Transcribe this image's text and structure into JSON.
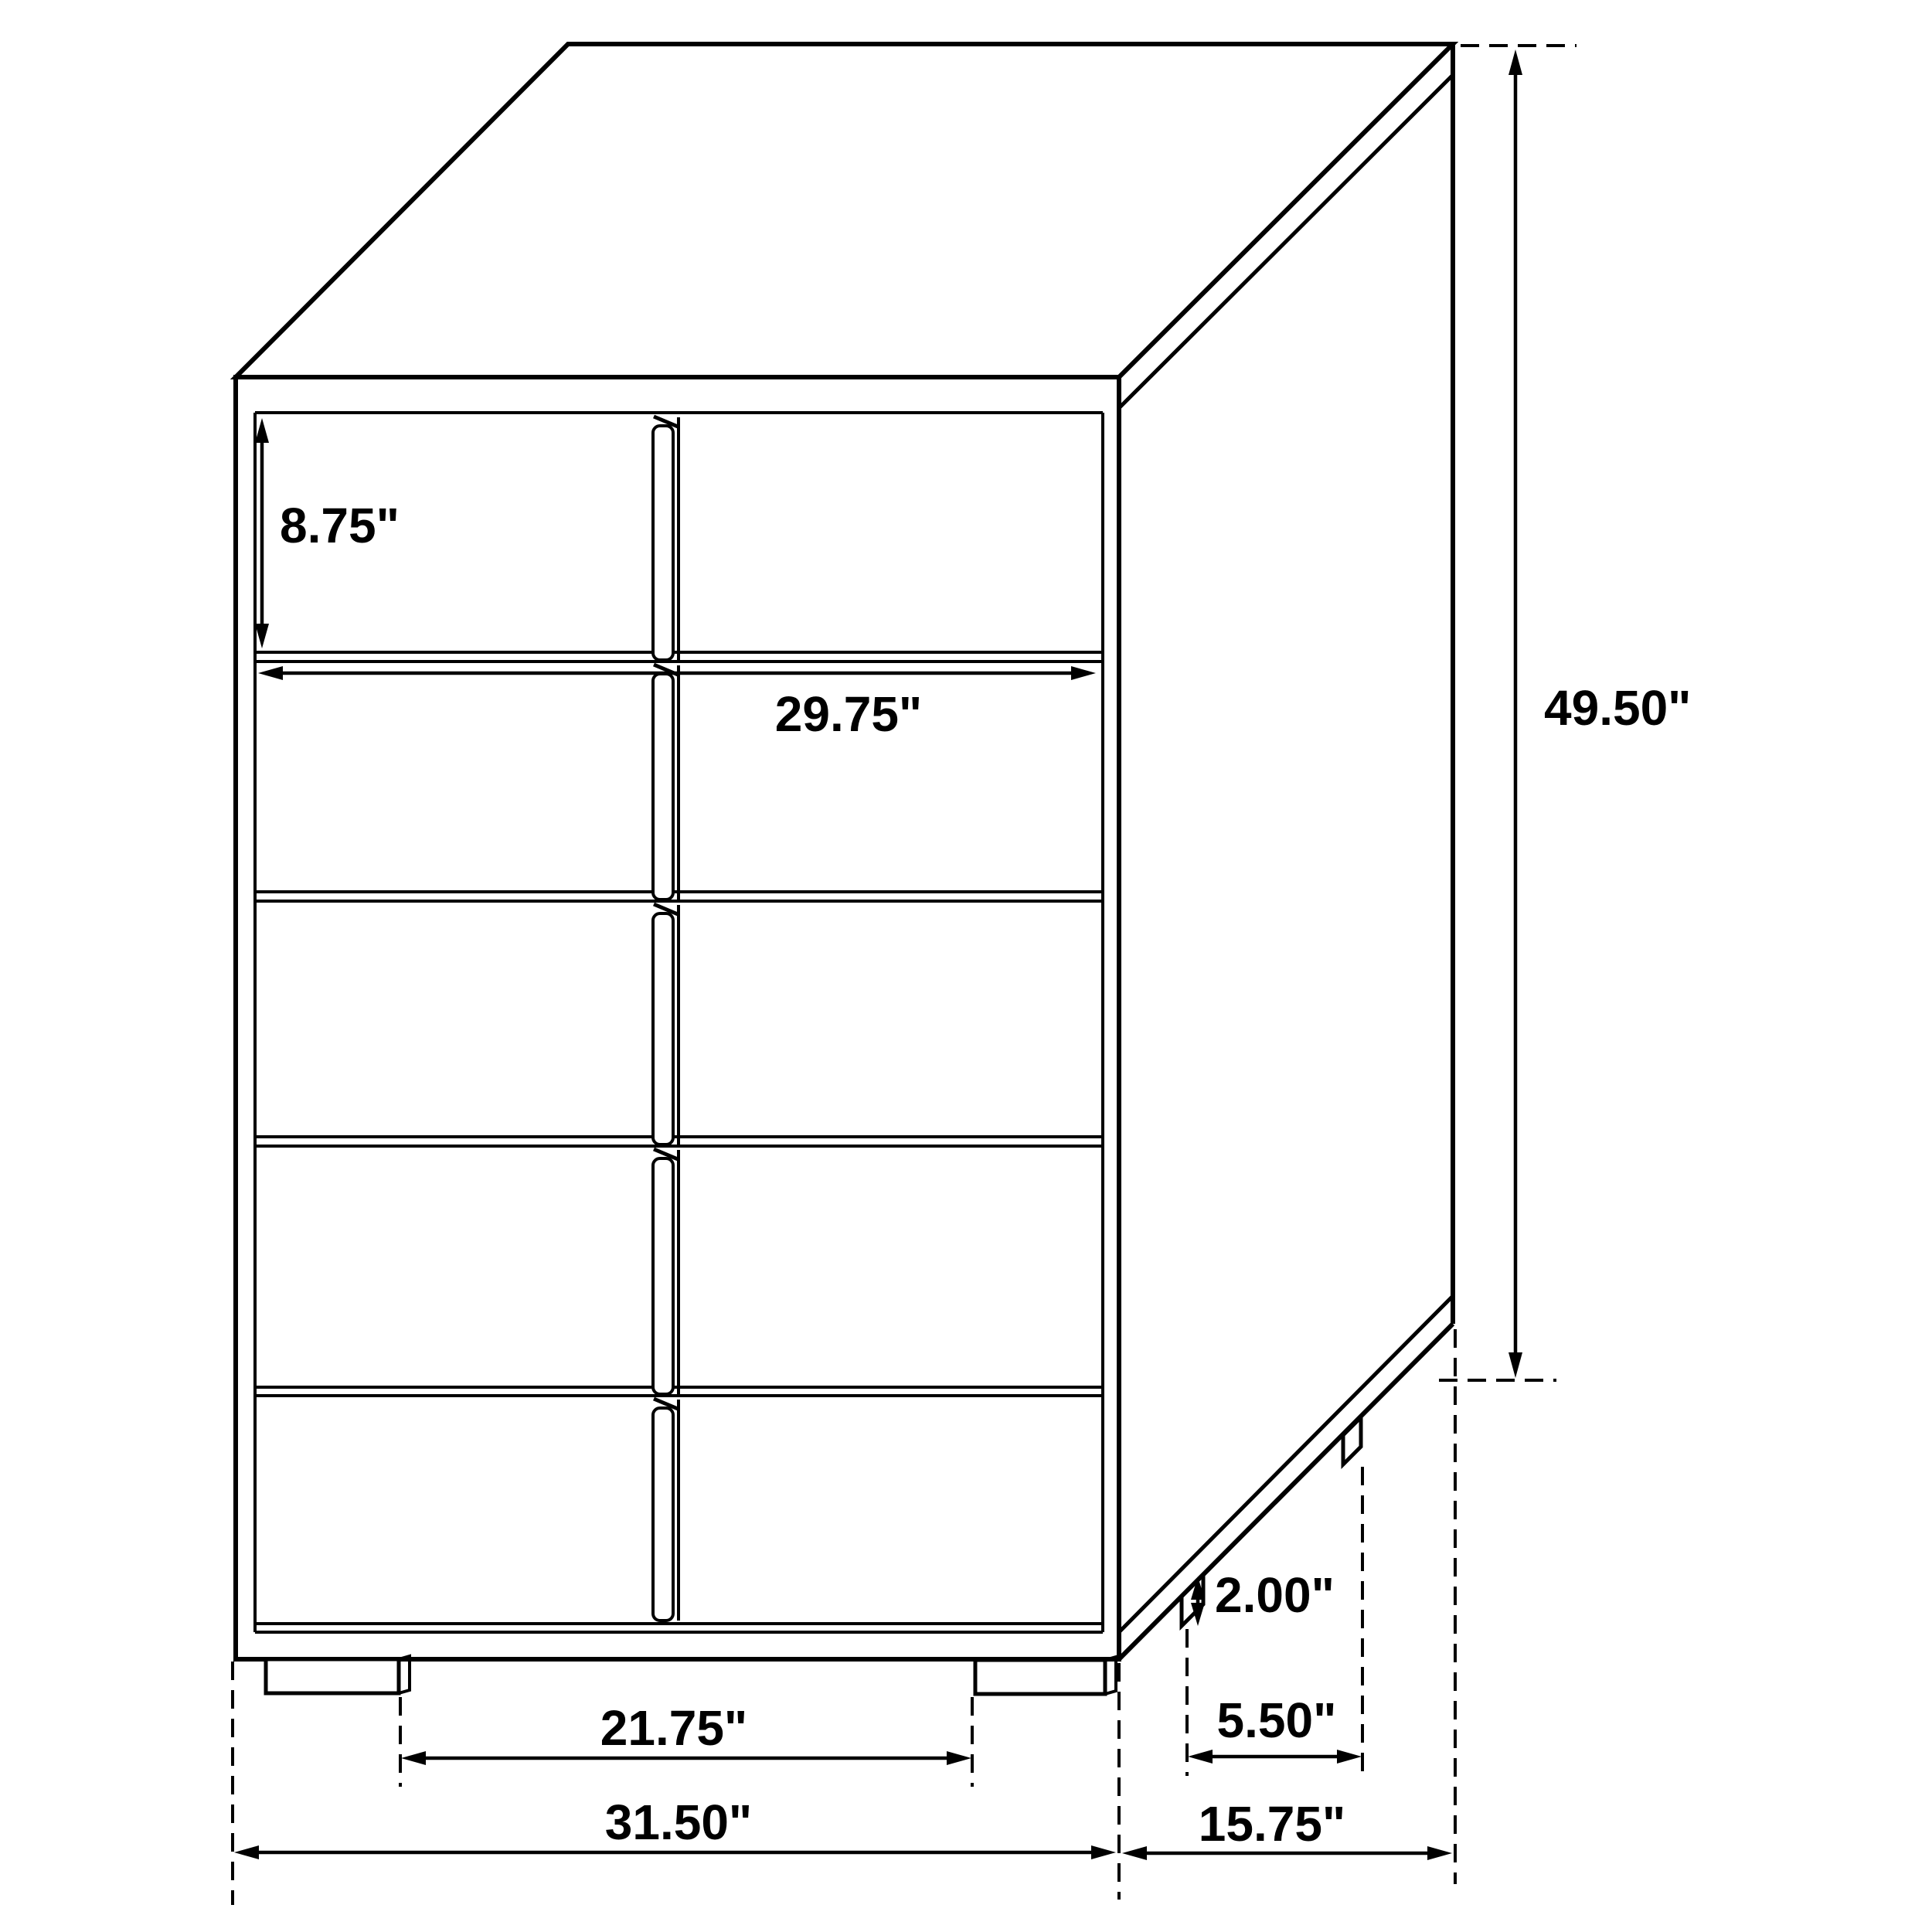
{
  "diagram": {
    "type": "furniture-dimension-drawing",
    "subject": "five-drawer chest, three-quarter perspective line drawing",
    "units": "inches",
    "line_color": "#000000",
    "background_color": "#ffffff",
    "dimensions": {
      "drawer_height": "8.75\"",
      "drawer_front_width": "29.75\"",
      "overall_height": "49.50\"",
      "foot_height": "2.00\"",
      "side_feet_spacing": "5.50\"",
      "front_feet_spacing": "21.75\"",
      "overall_width": "31.50\"",
      "overall_depth": "15.75\""
    }
  }
}
